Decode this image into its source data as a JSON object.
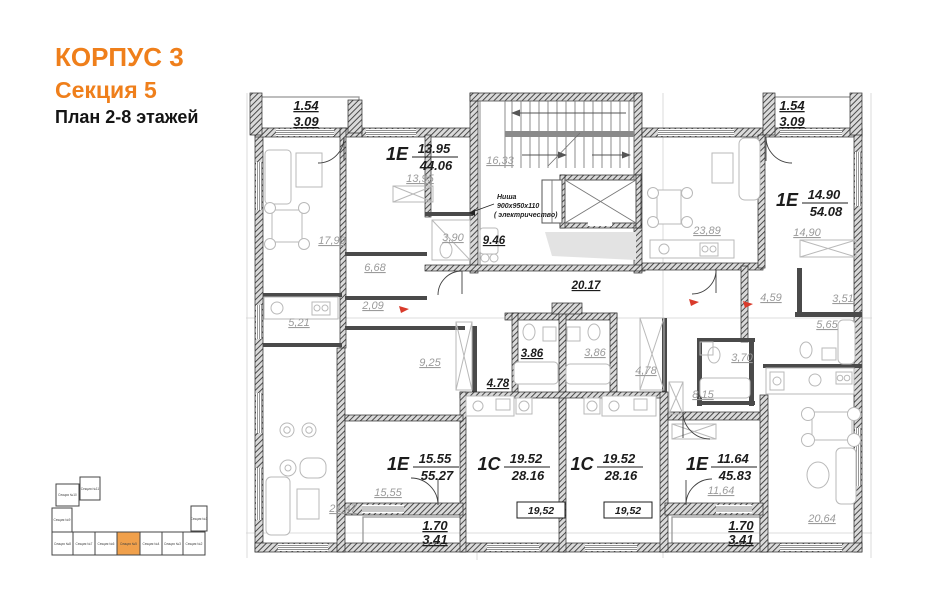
{
  "title": {
    "building": "КОРПУС 3",
    "section": "Секция 5",
    "floors": "План 2-8 этажей"
  },
  "colors": {
    "accent": "#ef7f1b",
    "wall": "#2b2b2b",
    "dim_text": "#9b9b9b",
    "black_text": "#1c1c1c",
    "red_mark": "#d93b2b"
  },
  "plan": {
    "apartments": [
      {
        "type": "1Е",
        "living_area": "13.95",
        "total_area": "44.06"
      },
      {
        "type": "1Е",
        "living_area": "14.90",
        "total_area": "54.08"
      },
      {
        "type": "1Е",
        "living_area": "15.55",
        "total_area": "55.27"
      },
      {
        "type": "1С",
        "living_area": "19.52",
        "total_area": "28.16"
      },
      {
        "type": "1С",
        "living_area": "19.52",
        "total_area": "28.16"
      },
      {
        "type": "1Е",
        "living_area": "11.64",
        "total_area": "45.83"
      }
    ],
    "room_labels": [
      "17,99",
      "13,95",
      "3,90",
      "16,33",
      "6,68",
      "2,09",
      "5,21",
      "23,89",
      "14,90",
      "9,25",
      "3,86",
      "4,78",
      "4,59",
      "3,51",
      "5,65",
      "3,70",
      "8,15",
      "21,47",
      "15,55",
      "11,64",
      "20,64"
    ],
    "common_labels": [
      "9.46",
      "20.17",
      "3.86",
      "4.78"
    ],
    "boxed_labels": [
      "19,52",
      "19,52"
    ],
    "balconies": [
      {
        "reduced": "1.54",
        "full": "3.09"
      },
      {
        "reduced": "1.54",
        "full": "3.09"
      },
      {
        "reduced": "1.70",
        "full": "3.41"
      },
      {
        "reduced": "1.70",
        "full": "3.41"
      }
    ],
    "niche_note": {
      "line1": "Ниша",
      "line2": "900х950х110",
      "line3": "( электричество)"
    }
  },
  "minimap": {
    "highlighted_section": "Секция №5",
    "sections": [
      {
        "label": "Секция №10"
      },
      {
        "label": "Секция №11"
      },
      {
        "label": "Секция №9"
      },
      {
        "label": "Секция №8"
      },
      {
        "label": "Секция №7"
      },
      {
        "label": "Секция №6"
      },
      {
        "label": "Секция №5",
        "highlighted": true
      },
      {
        "label": "Секция №4"
      },
      {
        "label": "Секция №3"
      },
      {
        "label": "Секция №2"
      },
      {
        "label": "Секция №1"
      }
    ]
  }
}
